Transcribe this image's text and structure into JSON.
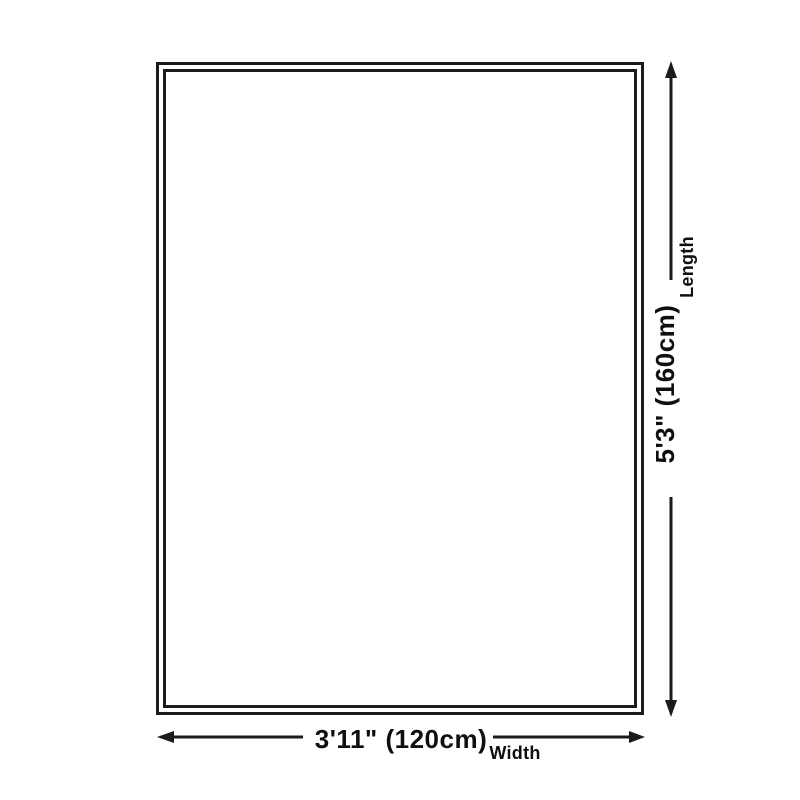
{
  "diagram": {
    "colors": {
      "background": "#ffffff",
      "line": "#1b1b1b",
      "text": "#0f0f0f"
    },
    "length": {
      "dimension": "5'3\" (160cm)",
      "axis_label": "Length"
    },
    "width": {
      "dimension": "3'11\" (120cm)",
      "axis_label": "Width"
    }
  }
}
